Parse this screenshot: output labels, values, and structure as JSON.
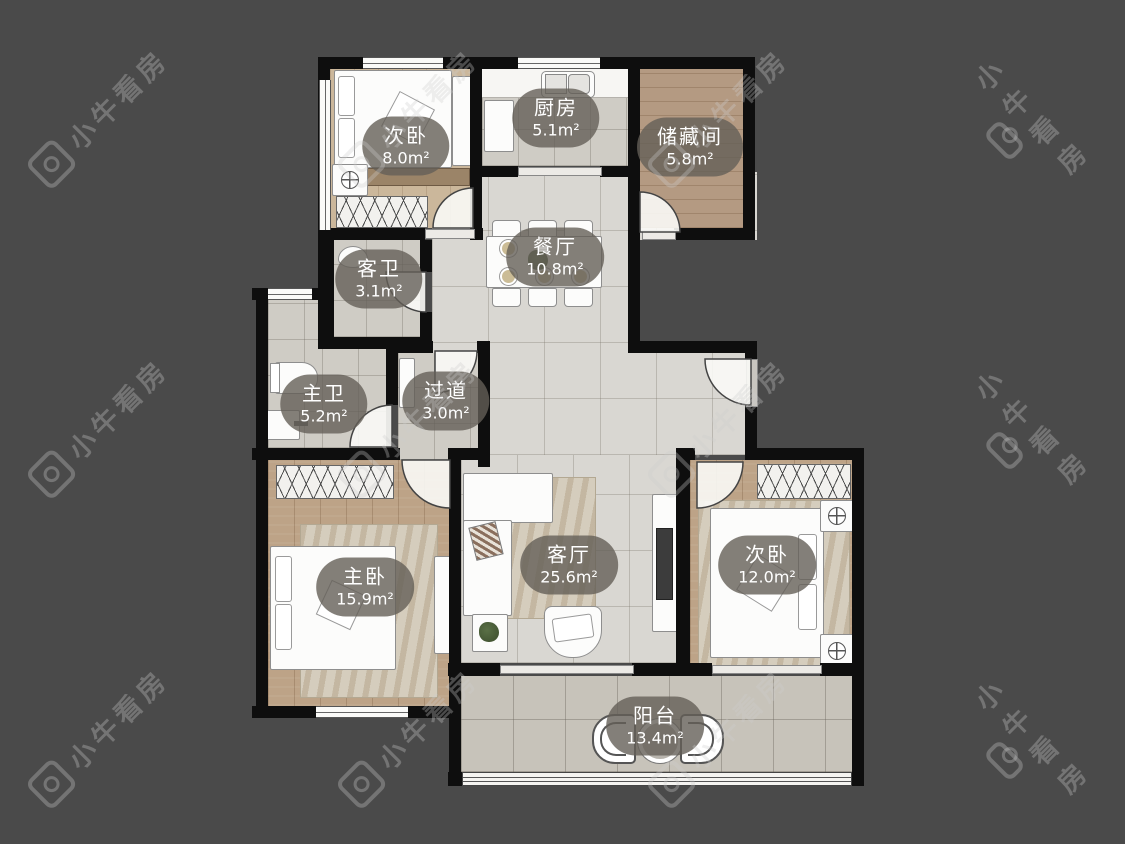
{
  "watermark": {
    "text": "小牛看房",
    "logo": "niu-logo"
  },
  "rooms": [
    {
      "id": "bedroom-top",
      "name": "次卧",
      "area": "8.0m²"
    },
    {
      "id": "kitchen",
      "name": "厨房",
      "area": "5.1m²"
    },
    {
      "id": "storage",
      "name": "储藏间",
      "area": "5.8m²"
    },
    {
      "id": "dining",
      "name": "餐厅",
      "area": "10.8m²"
    },
    {
      "id": "guest-bath",
      "name": "客卫",
      "area": "3.1m²"
    },
    {
      "id": "master-bath",
      "name": "主卫",
      "area": "5.2m²"
    },
    {
      "id": "hallway",
      "name": "过道",
      "area": "3.0m²"
    },
    {
      "id": "master-bedroom",
      "name": "主卧",
      "area": "15.9m²"
    },
    {
      "id": "living",
      "name": "客厅",
      "area": "25.6m²"
    },
    {
      "id": "bedroom-right",
      "name": "次卧",
      "area": "12.0m²"
    },
    {
      "id": "balcony",
      "name": "阳台",
      "area": "13.4m²"
    }
  ],
  "colors": {
    "background": "#4a4a4a",
    "wall": "#0e0e0e",
    "label_pill": "rgba(100,95,88,0.8)",
    "label_text": "#ffffff",
    "marble_floor": "#d9d7d2",
    "wood_floor": "#bda387",
    "tile_floor": "#cfccc5"
  }
}
